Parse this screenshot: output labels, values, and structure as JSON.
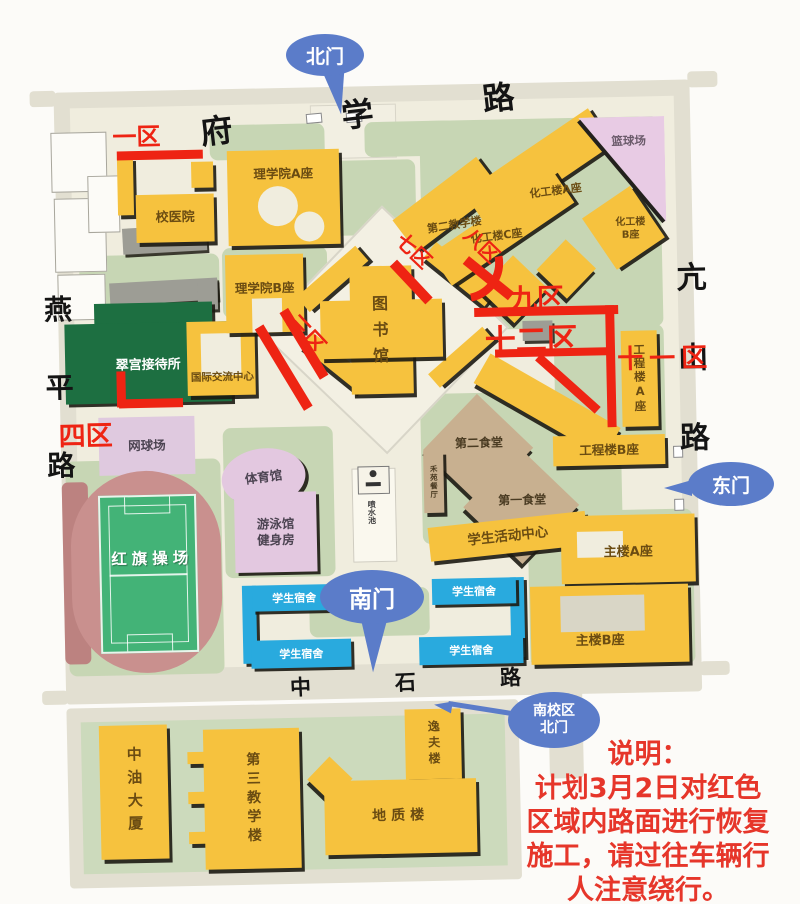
{
  "roads": {
    "north": "府学路",
    "west": "燕平路",
    "east": "亢山路",
    "south": "中石路"
  },
  "gates": {
    "north": "北门",
    "east": "东门",
    "south": "南门",
    "south_campus": "南校区\n北门"
  },
  "zones": {
    "z1": "一区",
    "z3": "三区",
    "z4": "四区",
    "z7": "七区",
    "z8": "八区",
    "z9": "九区",
    "z11": "十一区",
    "z12": "十二区"
  },
  "buildings": {
    "school_hospital": "校医院",
    "science_a": "理学院A座",
    "science_b": "理学院B座",
    "library": "图书馆",
    "teach2": "第二教学楼",
    "chem_a": "化工楼A座",
    "chem_b": "化工楼\nB座",
    "chem_c": "化工楼C座",
    "eng_a": "工程楼A座",
    "eng_b": "工程楼B座",
    "canteen2": "第二食堂",
    "canteen1": "第一食堂",
    "heyuan_restaurant": "禾苑餐厅",
    "fountain": "喷水池",
    "student_center": "学生活动中心",
    "main_a": "主楼A座",
    "main_b": "主楼B座",
    "gym": "体育馆",
    "swim": "游泳馆\n健身房",
    "tennis": "网球场",
    "basketball": "篮球场",
    "stadium": "红旗操场",
    "hotel": "翠宫接待所",
    "intl_center": "国际交流中心",
    "dorm": "学生宿舍",
    "zhongyou_tower": "中油大厦",
    "teach3": "第三教学楼",
    "yifu": "逸夫楼",
    "geology": "地质楼"
  },
  "notice": {
    "title": "说明：",
    "lines": [
      "计划3月2日对红色",
      "区域内路面进行恢复",
      "施工，请过往车辆行",
      "人注意绕行。"
    ]
  },
  "colors": {
    "building_yellow": "#f6c23e",
    "dorm_blue": "#29aade",
    "construction_red": "#ee2413",
    "gate_blue": "#5b7cc9",
    "canteen_tan": "#c8b090",
    "hotel_green": "#1d6f41",
    "court_pink": "#e3c8e0",
    "track_rose": "#c9908e",
    "pitch_green": "#43b377",
    "lawn_green": "#c7d6b4",
    "notice_red": "#e6362a"
  }
}
